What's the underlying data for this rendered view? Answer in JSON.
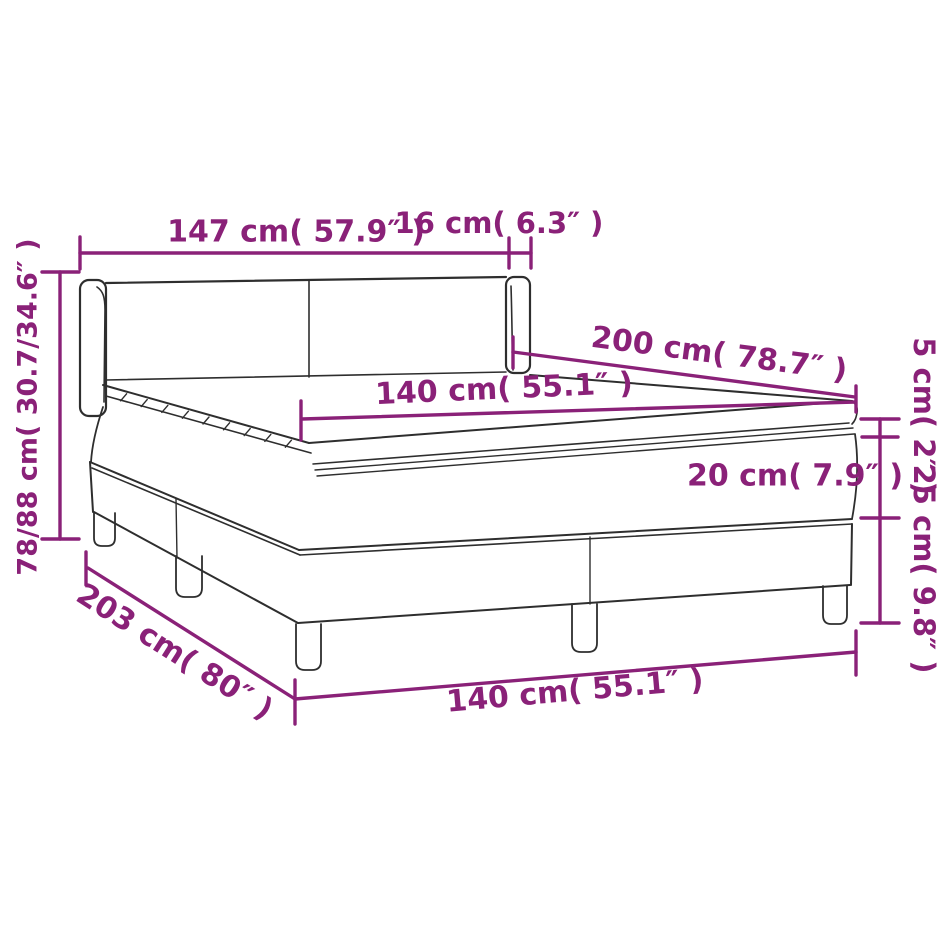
{
  "diagram": {
    "subject": "box-spring-bed-dimension-diagram",
    "accent_color": "#8a2178",
    "line_color": "#2e2e2e",
    "background_color": "#ffffff",
    "labels": {
      "headboard_width": "147 cm( 57.9″ )",
      "wing_depth": "16 cm( 6.3″ )",
      "overall_height": "78/88 cm( 30.7/34.6″ )",
      "mattress_length": "200 cm( 78.7″ )",
      "mattress_width_top": "140 cm( 55.1″ )",
      "topper_thickness": "5 cm( 2″ )",
      "mattress_thickness": "20 cm( 7.9″ )",
      "base_height": "25 cm( 9.8″ )",
      "frame_length": "203 cm( 80″ )",
      "frame_width_bottom": "140 cm( 55.1″ )"
    }
  }
}
